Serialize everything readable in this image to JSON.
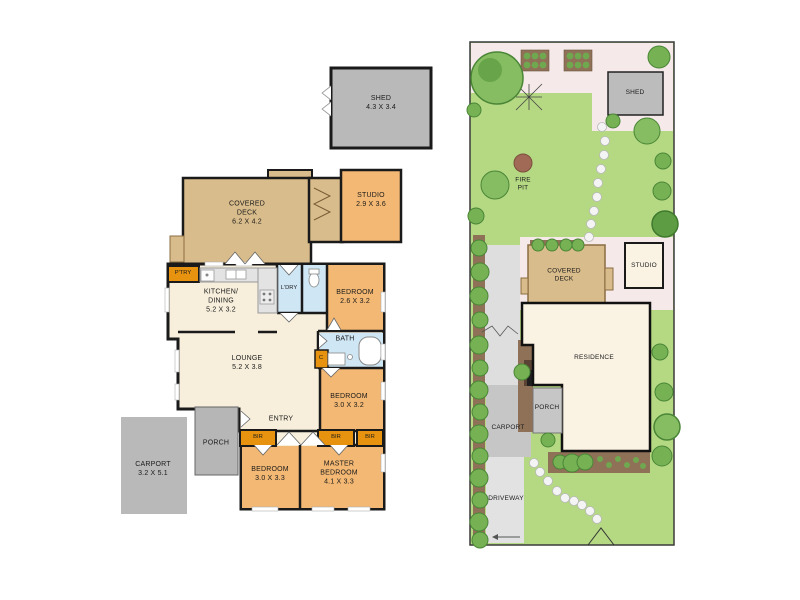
{
  "document_type": "property floor plan and site plan",
  "palette": {
    "wall_black": "#1a1a1a",
    "room_cream": "#f7efdc",
    "bedroom_orange": "#f3b873",
    "wet_area_blue": "#cfe6f4",
    "deck_tan": "#d9bc8b",
    "closet_orange": "#e8930f",
    "structure_gray": "#b9b9b9",
    "lawn_green": "#b5d983",
    "paving_pink": "#f5e9e9",
    "path_gray": "#dedede",
    "garden_brown": "#8f7158",
    "shrub_green": "#76b254",
    "stone_white": "#f4f4f4"
  },
  "floorplan": {
    "shed": {
      "label": "SHED\n4.3 X 3.4"
    },
    "covered_deck": {
      "label": "COVERED\nDECK\n6.2 X 4.2"
    },
    "studio": {
      "label": "STUDIO\n2.9 X 3.6"
    },
    "pantry": {
      "label": "P'TRY"
    },
    "kitchen_dining": {
      "label": "KITCHEN/\nDINING\n5.2 X 3.2"
    },
    "laundry": {
      "label": "L'DRY"
    },
    "bedroom_2": {
      "label": "BEDROOM\n2.6 X 3.2"
    },
    "bath": {
      "label": "BATH"
    },
    "cupboard": {
      "label": "C"
    },
    "lounge": {
      "label": "LOUNGE\n5.2 X 3.8"
    },
    "bedroom_3": {
      "label": "BEDROOM\n3.0 X 3.2"
    },
    "entry": {
      "label": "ENTRY"
    },
    "porch": {
      "label": "PORCH"
    },
    "bir_1": {
      "label": "BIR"
    },
    "bir_2": {
      "label": "BIR"
    },
    "bir_3": {
      "label": "BIR"
    },
    "bedroom_4": {
      "label": "BEDROOM\n3.0 X 3.3"
    },
    "master_bedroom": {
      "label": "MASTER\nBEDROOM\n4.1 X 3.3"
    },
    "carport": {
      "label": "CARPORT\n3.2 X 5.1"
    }
  },
  "siteplan": {
    "shed": {
      "label": "SHED"
    },
    "fire_pit": {
      "label": "FIRE\nPIT"
    },
    "covered_deck": {
      "label": "COVERED\nDECK"
    },
    "studio": {
      "label": "STUDIO"
    },
    "residence": {
      "label": "RESIDENCE"
    },
    "porch": {
      "label": "PORCH"
    },
    "carport": {
      "label": "CARPORT"
    },
    "driveway": {
      "label": "DRIVEWAY"
    }
  }
}
